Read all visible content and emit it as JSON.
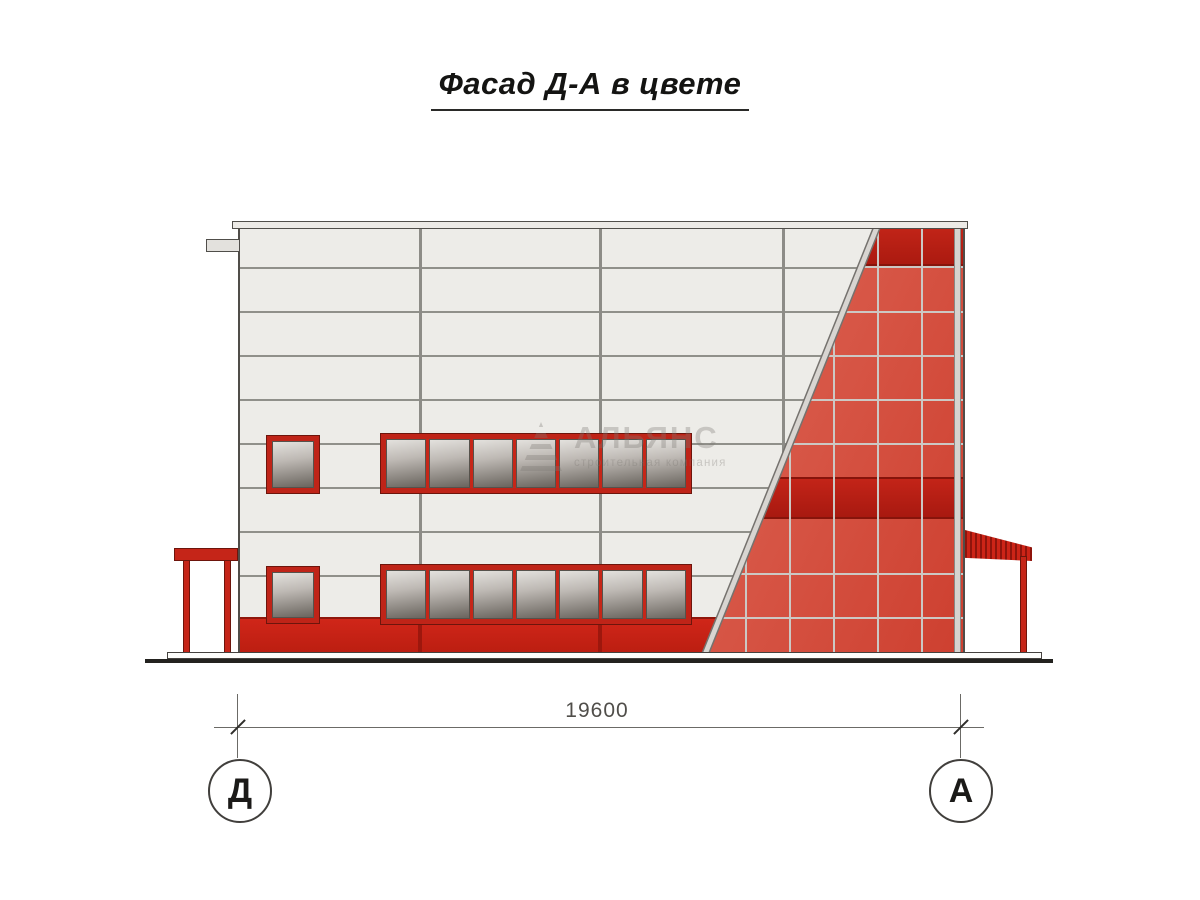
{
  "title": "Фасад Д-А в цвете",
  "dimension": {
    "total_width": "19600"
  },
  "axes": {
    "left": "Д",
    "right": "А"
  },
  "watermark": {
    "company": "АЛЬЯНС",
    "tagline": "строительная компания"
  },
  "palette": {
    "facade_red": "#c32217",
    "dark_red_band": "#ab1a10",
    "glazing_red": "#d8493a",
    "panel_white": "#edece8",
    "glass_gray": "#9b968f"
  },
  "facade": {
    "upper_ribbon_panes": 7,
    "lower_ribbon_panes": 7,
    "glazing_top_band_cells": 2
  }
}
